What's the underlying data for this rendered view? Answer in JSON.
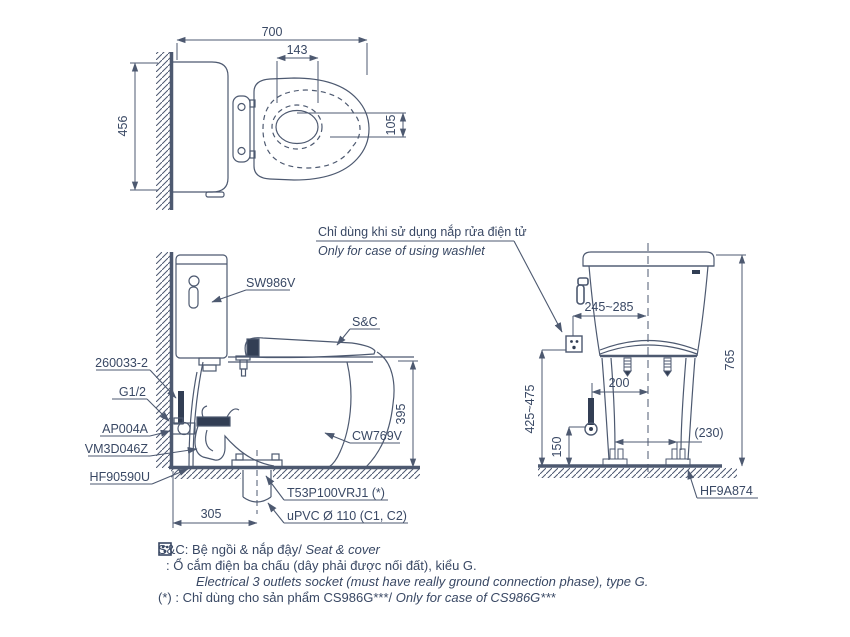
{
  "colors": {
    "line": "#4d5970",
    "text": "#394864",
    "dark_fill": "#323e54",
    "background": "#ffffff"
  },
  "washlet_note": {
    "vi": "Chỉ dùng khi sử dụng nắp rửa điện tử",
    "en": "Only for case of using washlet"
  },
  "top_view": {
    "dim_width": "700",
    "dim_hinge": "143",
    "dim_depth": "456",
    "dim_offset": "105"
  },
  "side_view": {
    "part_tank": "SW986V",
    "part_seat": "S&C",
    "part_supply": "260033-2",
    "part_thread": "G1/2",
    "part_valve": "AP004A",
    "part_trap": "VM3D046Z",
    "part_flange": "HF90590U",
    "part_bowl": "CW769V",
    "part_outlet": "T53P100VRJ1 (*)",
    "part_pipe": "uPVC Ø 110 (C1, C2)",
    "dim_rim_height": "395",
    "dim_outlet_distance": "305"
  },
  "front_view": {
    "dim_lever_offset": "245~285",
    "dim_total_height": "765",
    "dim_socket_height": "425~475",
    "dim_bolt_span": "200",
    "dim_valve_height": "150",
    "dim_foot_span": "(230)",
    "part_foot": "HF9A874"
  },
  "notes": {
    "seat": {
      "prefix": "S&C:",
      "vi": "Bệ ngồi & nắp đậy/",
      "en": "Seat & cover"
    },
    "socket": {
      "prefix": ":",
      "vi": "Ổ cắm điện ba chấu (dây phải được nối đất), kiểu G.",
      "en": "Electrical 3 outlets socket (must have really ground connection phase), type G."
    },
    "asterisk": {
      "prefix": "(*) :",
      "vi": "Chỉ dùng cho sản phẩm CS986G***/",
      "en": "Only for case of CS986G***"
    }
  }
}
